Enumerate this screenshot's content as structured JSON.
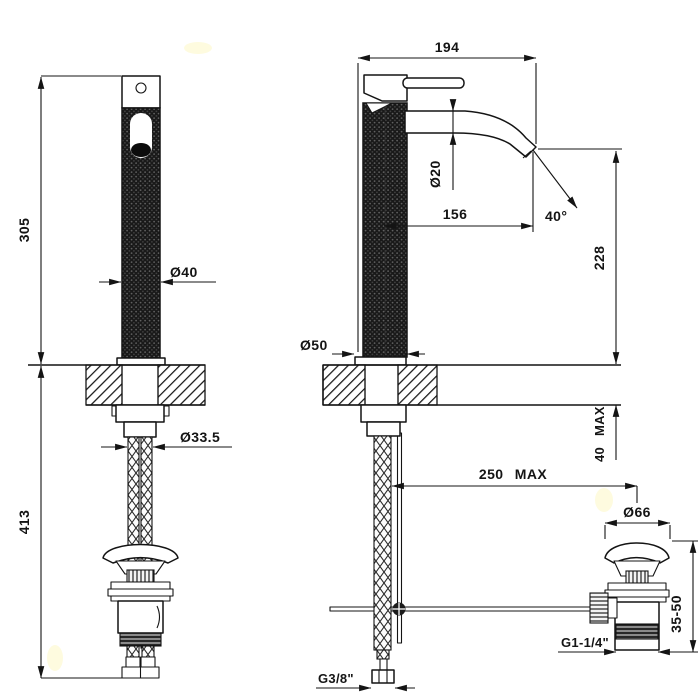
{
  "drawing": {
    "kind": "basin-mixer-faucet-technical-drawing",
    "paper_color": "#ffffff",
    "ink_color": "#141414"
  },
  "front_view": {
    "dim_height_above_deck": "305",
    "dim_height_below_deck": "413",
    "dim_body_diameter": "Ø40",
    "dim_hose_diameter": "Ø33.5"
  },
  "side_view": {
    "dim_total_depth": "194",
    "dim_spout_tube_diameter": "Ø20",
    "dim_spout_reach": "156",
    "dim_spout_angle": "40°",
    "dim_spout_height": "228",
    "dim_base_diameter": "Ø50",
    "dim_deck_thickness_max": "40 MAX",
    "dim_drain_offset_max": "250 MAX",
    "dim_drain_cap_diameter": "Ø66",
    "dim_drain_height_range": "35-50",
    "dim_drain_thread": "G1-1/4\"",
    "dim_supply_thread": "G3/8\""
  }
}
